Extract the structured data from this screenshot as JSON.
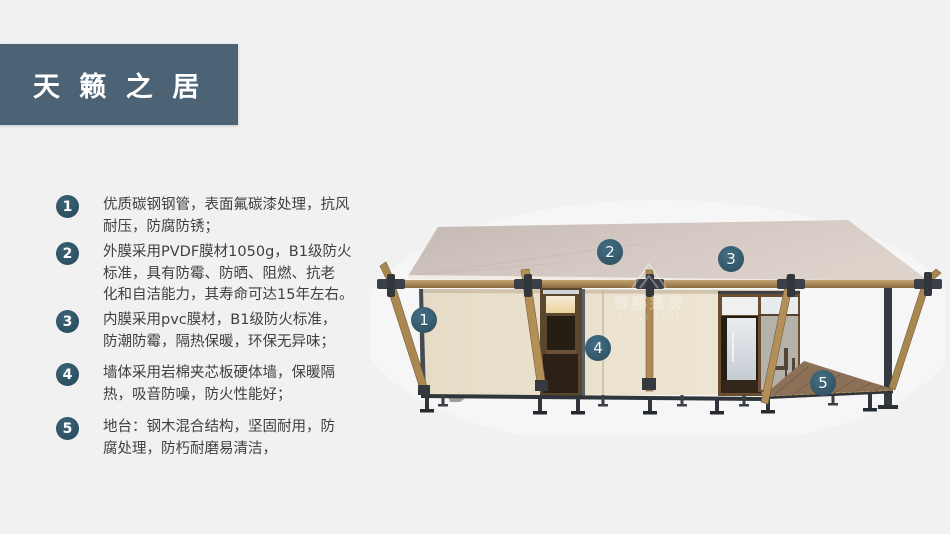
{
  "title": "天 籁 之 居",
  "features": [
    {
      "num": "1",
      "text": "优质碳钢钢管，表面氟碳漆处理，抗风\n耐压，防腐防锈；"
    },
    {
      "num": "2",
      "text": "外膜采用PVDF膜材1050g，B1级防火\n标准，具有防霉、防晒、阻燃、抗老\n化和自洁能力，其寿命可达15年左右。"
    },
    {
      "num": "3",
      "text": "内膜采用pvc膜材，B1级防火标准，\n防潮防霉，隔热保暖，环保无异味；"
    },
    {
      "num": "4",
      "text": "墙体采用岩棉夹芯板硬体墙，保暖隔\n热，吸音防噪，防火性能好；"
    },
    {
      "num": "5",
      "text": "地台：钢木混合结构，坚固耐用，防\n腐处理，防朽耐磨易清洁，"
    }
  ],
  "callouts": [
    {
      "num": "1"
    },
    {
      "num": "2"
    },
    {
      "num": "3"
    },
    {
      "num": "4"
    },
    {
      "num": "5"
    }
  ],
  "watermark": {
    "cn": "雪郦篷房",
    "en": "XUELI TENT"
  },
  "colors": {
    "background": "#f1f1f2",
    "banner": "#4c6375",
    "badge": "#2e5364",
    "callout": "#35596b",
    "text": "#404040",
    "roof": "#d2c6c0",
    "wall": "#ebe2cf",
    "wood": "#ab8851",
    "steel": "#343a40",
    "deck": "#8b7157"
  }
}
